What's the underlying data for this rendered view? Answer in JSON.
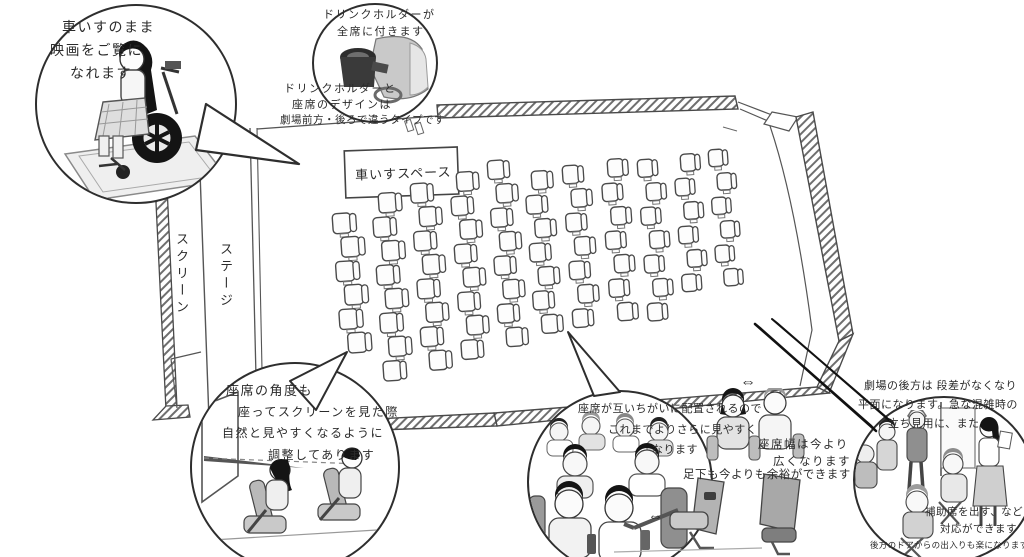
{
  "colors": {
    "ink": "#2e2e2e",
    "wall_hatch": "#6f6f6f",
    "shade_light": "#e9e9e9",
    "shade_mid": "#c6c6c6",
    "shade_dark": "#4a4a4a",
    "black": "#141414"
  },
  "icons": {
    "double_arrow": "⇔"
  },
  "plan": {
    "wheelchair_space_label": "車いすスペース",
    "screen_label": "スクリーン",
    "stage_label": "ステージ",
    "seat_columns": [
      {
        "x": 332,
        "y": 214,
        "count": 6
      },
      {
        "x": 371,
        "y": 194,
        "count": 8
      },
      {
        "x": 410,
        "y": 184,
        "count": 8
      },
      {
        "x": 449,
        "y": 173,
        "count": 8
      },
      {
        "x": 487,
        "y": 161,
        "count": 8
      },
      {
        "x": 524,
        "y": 172,
        "count": 7
      },
      {
        "x": 562,
        "y": 166,
        "count": 7
      },
      {
        "x": 600,
        "y": 160,
        "count": 7
      },
      {
        "x": 637,
        "y": 160,
        "count": 7
      },
      {
        "x": 673,
        "y": 155,
        "count": 6
      },
      {
        "x": 708,
        "y": 150,
        "count": 6
      }
    ],
    "seat": {
      "w": 24,
      "h": 20,
      "pitch": 24,
      "stagger": 7
    }
  },
  "bubbles": {
    "wheelchair": {
      "lines": [
        "車いすのまま",
        "映画をご覧に",
        "なれます"
      ]
    },
    "drink_holder": {
      "lines": [
        "ドリンクホルダーが",
        "全席に付きます"
      ]
    },
    "drink_holder_note": {
      "lines": [
        "ドリンクホルダーと",
        "座席のデザインは",
        "劇場前方・後ろで違うタイプです"
      ]
    },
    "seat_angle": {
      "lines": [
        "座席の角度も",
        "座ってスクリーンを見た際",
        "自然と見やすくなるように",
        "調整してあります"
      ]
    },
    "staggered_seats": {
      "lines": [
        "座席が互いちがいに配置されるので",
        "これまでよりさらに見やすく",
        "なります"
      ]
    },
    "seat_width": {
      "lines": [
        "座席幅は今より",
        "広くなります"
      ]
    },
    "legroom": {
      "line": "足下も今よりも余裕ができます"
    },
    "rear_flat": {
      "lines": [
        "劇場の後方は 段差がなくなり",
        "平面になります。急な混雑時の",
        "立ち見用に、また"
      ]
    },
    "aux_seats": {
      "lines": [
        "補助席を出す、などの",
        "対応ができます",
        "後方のドアからの出入りも楽になります"
      ]
    }
  }
}
